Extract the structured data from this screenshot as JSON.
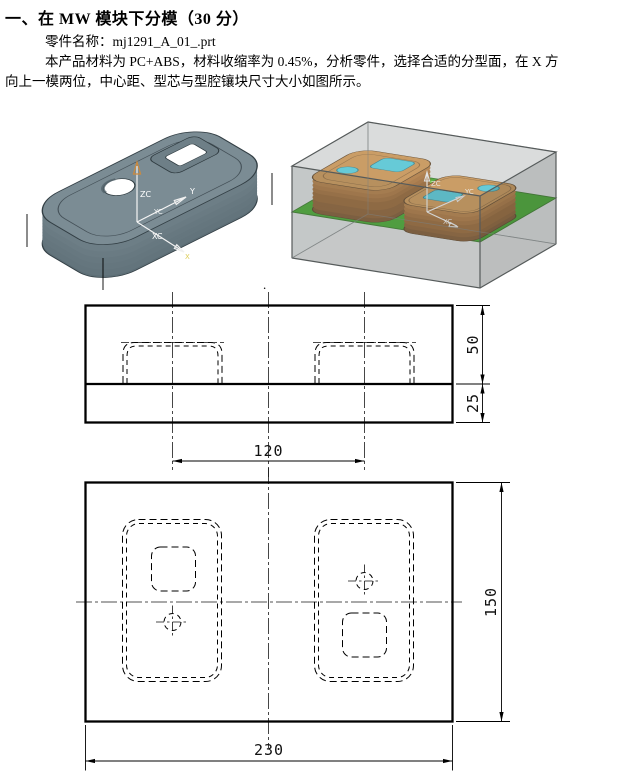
{
  "document": {
    "heading": "一、在 MW 模块下分模（30 分）",
    "part_line": "零件名称：mj1291_A_01_.prt",
    "body_line1": "本产品材料为 PC+ABS，材料收缩率为 0.45%，分析零件，选择合适的分型面，在 X 方",
    "body_line2": "向上一模两位，中心距、型芯与型腔镶块尺寸大小如图所示。",
    "trailing_dot": "."
  },
  "part_render": {
    "axis_z": "ZC",
    "axis_y_tip": "Y",
    "axis_y": "YC",
    "axis_x": "XC",
    "axis_x_tip": "X",
    "colors": {
      "body_top": "#7b8c94",
      "body_side": "#63747c",
      "outline": "#323e44"
    }
  },
  "mold_render": {
    "axis_z": "ZC",
    "axis_y": "YC",
    "axis_x": "XC",
    "colors": {
      "workpiece": "#a8acac",
      "parting_plane": "#2b9e10",
      "plane_highlight": "#5cc61e",
      "core_top": "#c98a3e",
      "core_side": "#7e4914",
      "insert_cyan": "#3fc8da"
    }
  },
  "drawings": {
    "side_view": {
      "dim_cavity_height": "50",
      "dim_base_height": "25",
      "dim_center_distance": "120"
    },
    "plan_view": {
      "dim_height": "150",
      "dim_width": "230"
    }
  }
}
